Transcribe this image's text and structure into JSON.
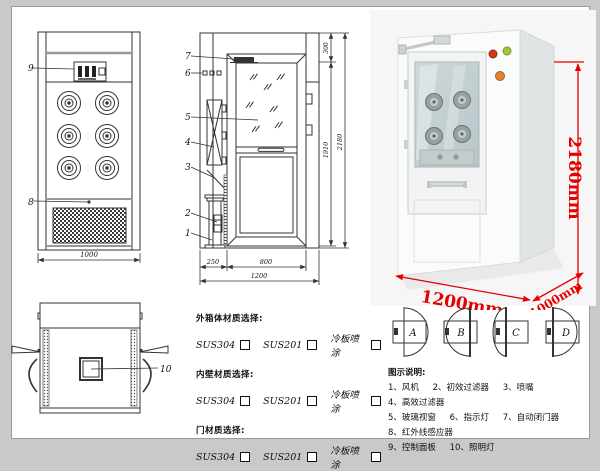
{
  "colors": {
    "line": "#333333",
    "dim_red": "#e60000"
  },
  "front_view": {
    "label_control_panel": "9",
    "label_grille": "8",
    "dim_width": "1000"
  },
  "side_view": {
    "labels": {
      "l7": "7",
      "l6": "6",
      "l5": "5",
      "l4": "4",
      "l3": "3",
      "l2": "2",
      "l1": "1"
    },
    "dim_top": "300",
    "dim_inner_height": "1910",
    "dim_total_height": "2180",
    "dim_bottom_left": "250",
    "dim_bottom_door": "800",
    "dim_bottom_total": "1200"
  },
  "photo": {
    "dim_height": "2180mm",
    "dim_width": "1200mm",
    "dim_depth": "1000mm"
  },
  "top_view": {
    "label_light": "10"
  },
  "materials": {
    "sections": [
      {
        "title": "外箱体材质选择:",
        "opt1": "SUS304",
        "opt2": "SUS201",
        "opt3": "冷板喷涂"
      },
      {
        "title": "内壁材质选择:",
        "opt1": "SUS304",
        "opt2": "SUS201",
        "opt3": "冷板喷涂"
      },
      {
        "title": "门材质选择:",
        "opt1": "SUS304",
        "opt2": "SUS201",
        "opt3": "冷板喷涂"
      }
    ]
  },
  "door_options": {
    "a": "A",
    "b": "B",
    "c": "C",
    "d": "D"
  },
  "legend": {
    "title": "图示说明:",
    "items": [
      "1、风机",
      "2、初效过滤器",
      "3、喷嘴",
      "4、高效过滤器",
      "5、玻璃视窗",
      "6、指示灯",
      "7、自动闭门器",
      "8、红外线感应器",
      "9、控制面板",
      "10、照明灯"
    ]
  }
}
